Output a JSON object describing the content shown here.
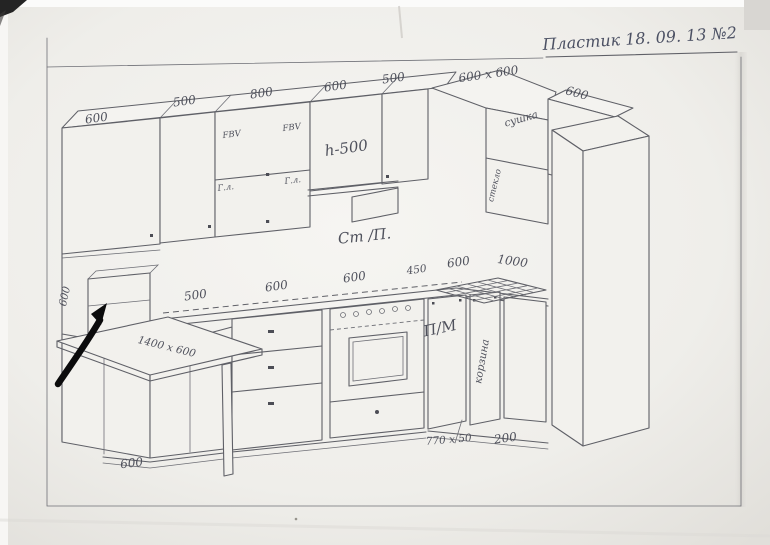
{
  "sheet": {
    "title": "Пластик 18. 09. 13 №2"
  },
  "upper_run": {
    "dims": {
      "cab1": "600",
      "cab2": "500",
      "cab3": "800",
      "cab4": "600",
      "cab5": "500",
      "corner": "600 x 600",
      "right_wall": "600"
    },
    "notes": {
      "door_left": "FBV",
      "door_right": "FBV",
      "lift_left": "Г.л.",
      "lift_right": "Г.л.",
      "height": "h-500",
      "corner_word_top": "сушка",
      "corner_word_side": "стекло"
    }
  },
  "counter": {
    "note": "Ст /П.",
    "dims": {
      "d1": "500",
      "d2": "600",
      "d3": "600",
      "d4": "450",
      "d5": "600",
      "d6": "1000"
    }
  },
  "base_run": {
    "dishwasher": "П/М",
    "basket": "корзина",
    "table": "1400 x 600",
    "side_height": "600",
    "plinth_depth": "600",
    "plinth_profile": "770 x 50",
    "gap": "200"
  }
}
